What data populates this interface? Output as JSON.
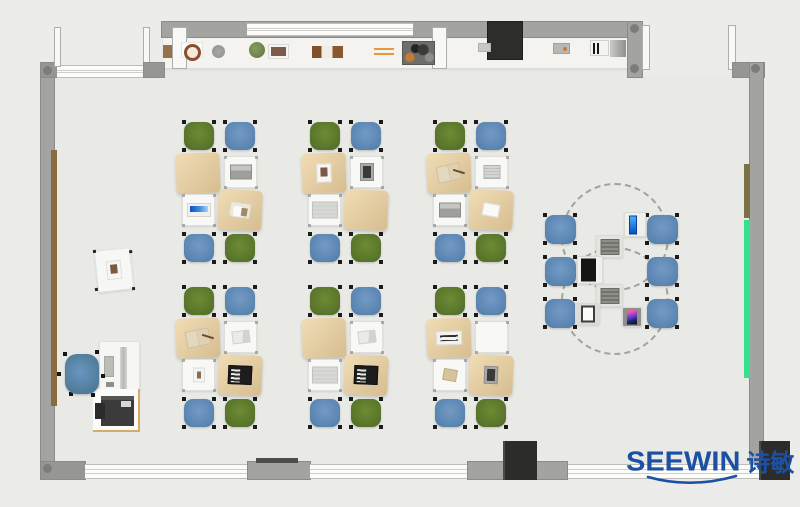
{
  "brand": {
    "name": "SEEWIN",
    "cn": "诗敏",
    "color": "#1b50a5"
  },
  "palette": {
    "exterior": "#ececeb",
    "floor": "#e9e9e5",
    "wall": "#a3a3a1",
    "chair_green": "#5a762b",
    "chair_blue": "#5c87b3",
    "desk_cover_tan": "#e2cba1",
    "desk_white": "#f8f8f6",
    "accent_green_strip": "#35e18d",
    "accent_olive_strip": "#7b7147",
    "door_brown_strip": "#8a6a40",
    "logo_blue": "#1b50a5"
  },
  "scene": {
    "clusters": [
      {
        "x": 178,
        "y": 120,
        "top_chairs": [
          "green",
          "blue"
        ],
        "bottom_chairs": [
          "blue",
          "green"
        ],
        "desks": [
          {
            "row": 1,
            "col": 1,
            "type": "cover",
            "item": null
          },
          {
            "row": 1,
            "col": 2,
            "type": "white",
            "item": "laptop-gray"
          },
          {
            "row": 2,
            "col": 1,
            "type": "white",
            "item": "screen-blue"
          },
          {
            "row": 2,
            "col": 2,
            "type": "cover",
            "item": "stationery"
          }
        ]
      },
      {
        "x": 304,
        "y": 120,
        "top_chairs": [
          "green",
          "blue"
        ],
        "bottom_chairs": [
          "blue",
          "green"
        ],
        "desks": [
          {
            "row": 1,
            "col": 1,
            "type": "cover",
            "item": "photo"
          },
          {
            "row": 1,
            "col": 2,
            "type": "white",
            "item": "tablet-dark"
          },
          {
            "row": 2,
            "col": 1,
            "type": "white",
            "item": "book-gray"
          },
          {
            "row": 2,
            "col": 2,
            "type": "cover",
            "item": null
          }
        ]
      },
      {
        "x": 429,
        "y": 120,
        "top_chairs": [
          "green",
          "blue"
        ],
        "bottom_chairs": [
          "blue",
          "green"
        ],
        "desks": [
          {
            "row": 1,
            "col": 1,
            "type": "cover",
            "item": "book-tan"
          },
          {
            "row": 1,
            "col": 2,
            "type": "white",
            "item": "notebook"
          },
          {
            "row": 2,
            "col": 1,
            "type": "white",
            "item": "laptop-gray"
          },
          {
            "row": 2,
            "col": 2,
            "type": "cover",
            "item": "paper"
          }
        ]
      },
      {
        "x": 178,
        "y": 285,
        "top_chairs": [
          "green",
          "blue"
        ],
        "bottom_chairs": [
          "blue",
          "green"
        ],
        "desks": [
          {
            "row": 1,
            "col": 1,
            "type": "cover",
            "item": "book-tan"
          },
          {
            "row": 1,
            "col": 2,
            "type": "white",
            "item": "paper-folded"
          },
          {
            "row": 2,
            "col": 1,
            "type": "white",
            "item": "photo-small"
          },
          {
            "row": 2,
            "col": 2,
            "type": "cover",
            "item": "laptop-black"
          }
        ]
      },
      {
        "x": 304,
        "y": 285,
        "top_chairs": [
          "green",
          "blue"
        ],
        "bottom_chairs": [
          "blue",
          "green"
        ],
        "desks": [
          {
            "row": 1,
            "col": 1,
            "type": "cover",
            "item": null
          },
          {
            "row": 1,
            "col": 2,
            "type": "white",
            "item": "paper-folded"
          },
          {
            "row": 2,
            "col": 1,
            "type": "white",
            "item": "book-gray"
          },
          {
            "row": 2,
            "col": 2,
            "type": "cover",
            "item": "laptop-black"
          }
        ]
      },
      {
        "x": 429,
        "y": 285,
        "top_chairs": [
          "green",
          "blue"
        ],
        "bottom_chairs": [
          "blue",
          "green"
        ],
        "desks": [
          {
            "row": 1,
            "col": 1,
            "type": "cover",
            "item": "keyboard-white"
          },
          {
            "row": 1,
            "col": 2,
            "type": "white",
            "item": null
          },
          {
            "row": 2,
            "col": 1,
            "type": "white",
            "item": "booklet"
          },
          {
            "row": 2,
            "col": 2,
            "type": "cover",
            "item": "tablet-dark"
          }
        ]
      }
    ],
    "collab": {
      "circles": [
        {
          "x": 561,
          "y": 183,
          "d": 108
        },
        {
          "x": 561,
          "y": 247,
          "d": 108
        }
      ],
      "chairs": [
        {
          "x": 543,
          "y": 213
        },
        {
          "x": 543,
          "y": 255
        },
        {
          "x": 543,
          "y": 297
        },
        {
          "x": 645,
          "y": 213
        },
        {
          "x": 645,
          "y": 255
        },
        {
          "x": 645,
          "y": 297
        }
      ],
      "devices": [
        {
          "x": 624,
          "y": 212,
          "type": "phone-blue"
        },
        {
          "x": 596,
          "y": 235,
          "type": "laptop-pad"
        },
        {
          "x": 577,
          "y": 256,
          "type": "laptop-black-pad"
        },
        {
          "x": 596,
          "y": 284,
          "type": "laptop-pad"
        },
        {
          "x": 575,
          "y": 303,
          "type": "laptop-white-pad"
        },
        {
          "x": 622,
          "y": 307,
          "type": "phone-color"
        }
      ]
    },
    "teacher": {
      "side_desk": {
        "x": 96,
        "y": 249
      },
      "chair": {
        "x": 61,
        "y": 350
      },
      "desk": {
        "x": 99,
        "y": 341
      },
      "printer_table": {
        "x": 93,
        "y": 389
      }
    },
    "shelf_items": [
      {
        "x": 163,
        "y": 45,
        "type": "box-brown"
      },
      {
        "x": 181,
        "y": 42,
        "type": "plate-wreath"
      },
      {
        "x": 212,
        "y": 45,
        "type": "plate-gray"
      },
      {
        "x": 249,
        "y": 42,
        "type": "plant"
      },
      {
        "x": 268,
        "y": 44,
        "type": "frame"
      },
      {
        "x": 312,
        "y": 46,
        "type": "books"
      },
      {
        "x": 374,
        "y": 48,
        "type": "pencils"
      },
      {
        "x": 402,
        "y": 41,
        "type": "tool-tray"
      },
      {
        "x": 478,
        "y": 43,
        "type": "chip"
      },
      {
        "x": 553,
        "y": 43,
        "type": "device-dot"
      },
      {
        "x": 590,
        "y": 40,
        "type": "piano"
      },
      {
        "x": 610,
        "y": 40,
        "type": "shelf-end"
      }
    ]
  }
}
